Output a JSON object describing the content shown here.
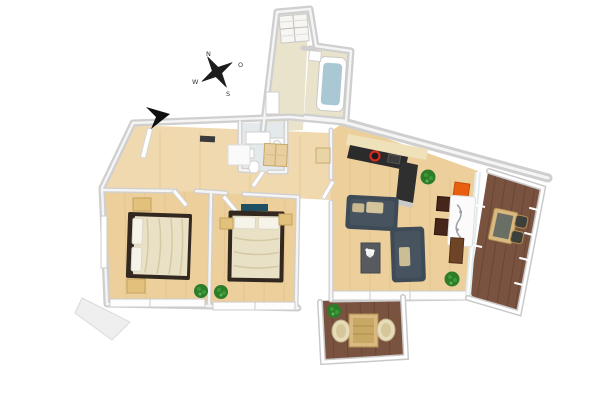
{
  "scene": {
    "description": "3D rendered top-down floor plan of a two-bedroom apartment with two wooden balconies",
    "background": "#ffffff"
  },
  "compass": {
    "n": "N",
    "e": "O",
    "s": "S",
    "w": "W"
  },
  "colors": {
    "wall": "#cfcfcf",
    "wall_top": "#f5f5f5",
    "wood_floor": "#eccf9b",
    "wood_floor_hall": "#f0d9ae",
    "bath_tile": "#eae3cb",
    "wc_tile": "#e4eaeb",
    "deck": "#7a5340",
    "deck_line": "#67432f",
    "sofa": "#3e4a55",
    "sofa_cushion": "#d3c49c",
    "bed_frame": "#322820",
    "bed_duvet": "#e9e1c6",
    "pillow": "#f6f3e8",
    "nightstand": "#e2c17d",
    "kitchen_counter": "#2b2b2b",
    "kitchen_back_counter": "#efe2ba",
    "cooktop": "#d4291d",
    "dining_table": "#fbfbfb",
    "chair_orange": "#e8600f",
    "chair_dark": "#46251a",
    "sideboard": "#6e4426",
    "plant": "#3c9b37",
    "plant_dark": "#2d7c2a",
    "bath_water": "#a9c8d4",
    "glass": "#e3ebed",
    "railing": "#ffffff",
    "door": "#ffffff",
    "compass_ink": "#1c1c1c",
    "arrow": "#101010",
    "terrace_table": "#d9b97f",
    "wicker_chair": "#e7dcba",
    "art_teal": "#1f4f63",
    "ledge": "#efefef"
  },
  "rooms": [
    {
      "id": "entry-hall",
      "floor": "wood",
      "furniture": [
        "wardrobe",
        "dresser",
        "wall-shelf"
      ]
    },
    {
      "id": "bathroom",
      "floor": "tile",
      "fixtures": [
        "skylight",
        "bathtub",
        "sink"
      ]
    },
    {
      "id": "wc",
      "floor": "tile",
      "fixtures": [
        "vanity",
        "washing-machine",
        "sink",
        "toilet"
      ]
    },
    {
      "id": "bedroom-1",
      "floor": "wood",
      "furniture": [
        "double-bed",
        "nightstand",
        "nightstand",
        "plant"
      ]
    },
    {
      "id": "bedroom-2",
      "floor": "wood",
      "furniture": [
        "double-bed",
        "nightstand",
        "nightstand",
        "wall-art",
        "plant"
      ]
    },
    {
      "id": "living-room",
      "floor": "wood",
      "furniture": [
        "kitchen-counter",
        "cooktop",
        "sofa",
        "sofa",
        "coffee-table",
        "dining-table",
        "orange-chair",
        "dark-chair",
        "dark-chair",
        "sideboard",
        "plant",
        "plant"
      ]
    },
    {
      "id": "balcony-right",
      "floor": "deck",
      "furniture": [
        "bistro-table",
        "chair",
        "chair"
      ]
    },
    {
      "id": "terrace-bottom",
      "floor": "deck",
      "furniture": [
        "table",
        "wicker-chair",
        "wicker-chair",
        "plant"
      ]
    }
  ]
}
